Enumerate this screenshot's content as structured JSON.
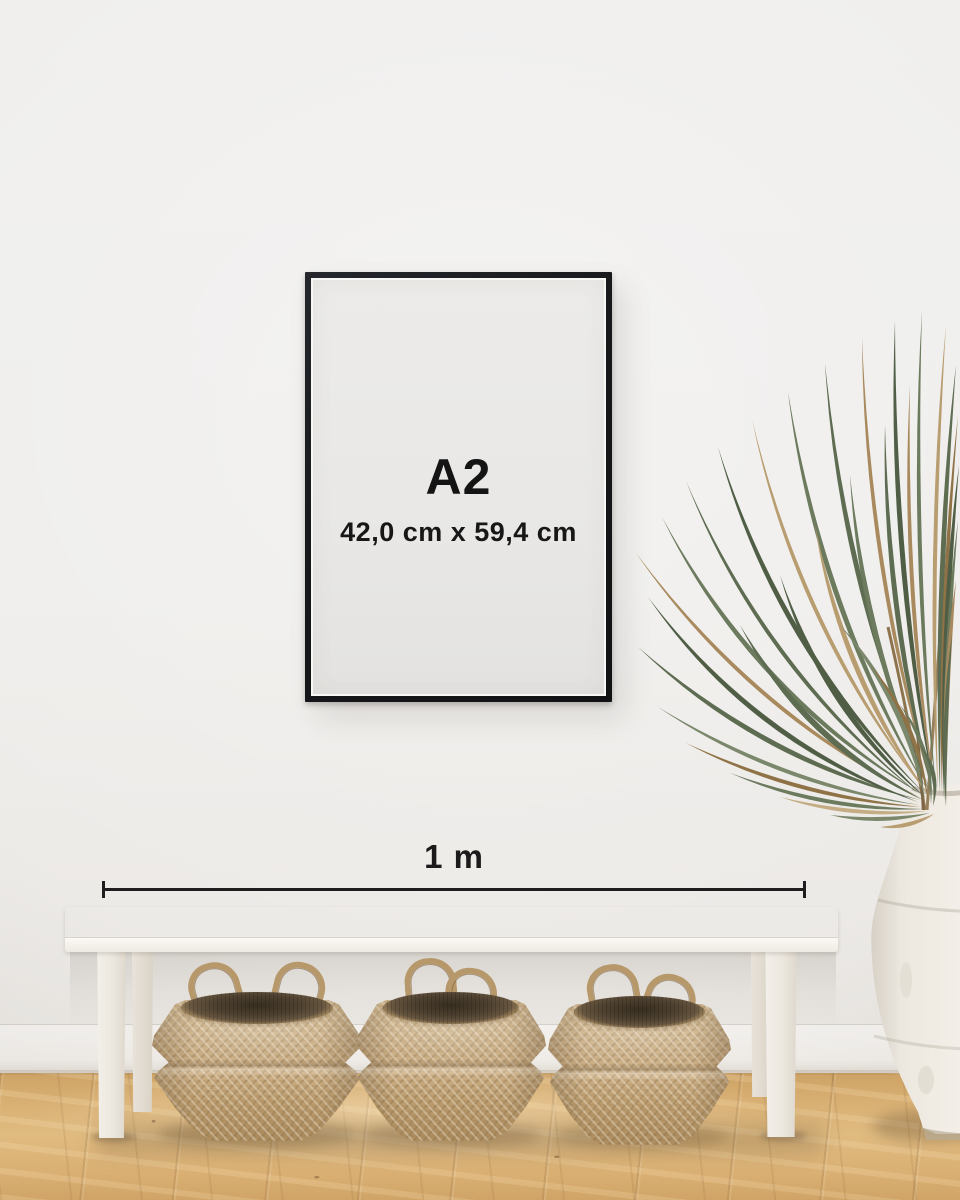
{
  "poster": {
    "size_label": "A2",
    "dimensions": "42,0 cm x 59,4 cm"
  },
  "scale": {
    "label": "1 m"
  },
  "colors": {
    "frame": "#17191c",
    "poster": "#e9e8e6",
    "wall": "#efeeec",
    "floor": "#d8af73",
    "text": "#161616",
    "bench": "#f6f3ef",
    "basket": "#c5a77c",
    "plant_green": "#5e6c52",
    "plant_dried": "#a98a5e",
    "vase": "#ece7df"
  }
}
